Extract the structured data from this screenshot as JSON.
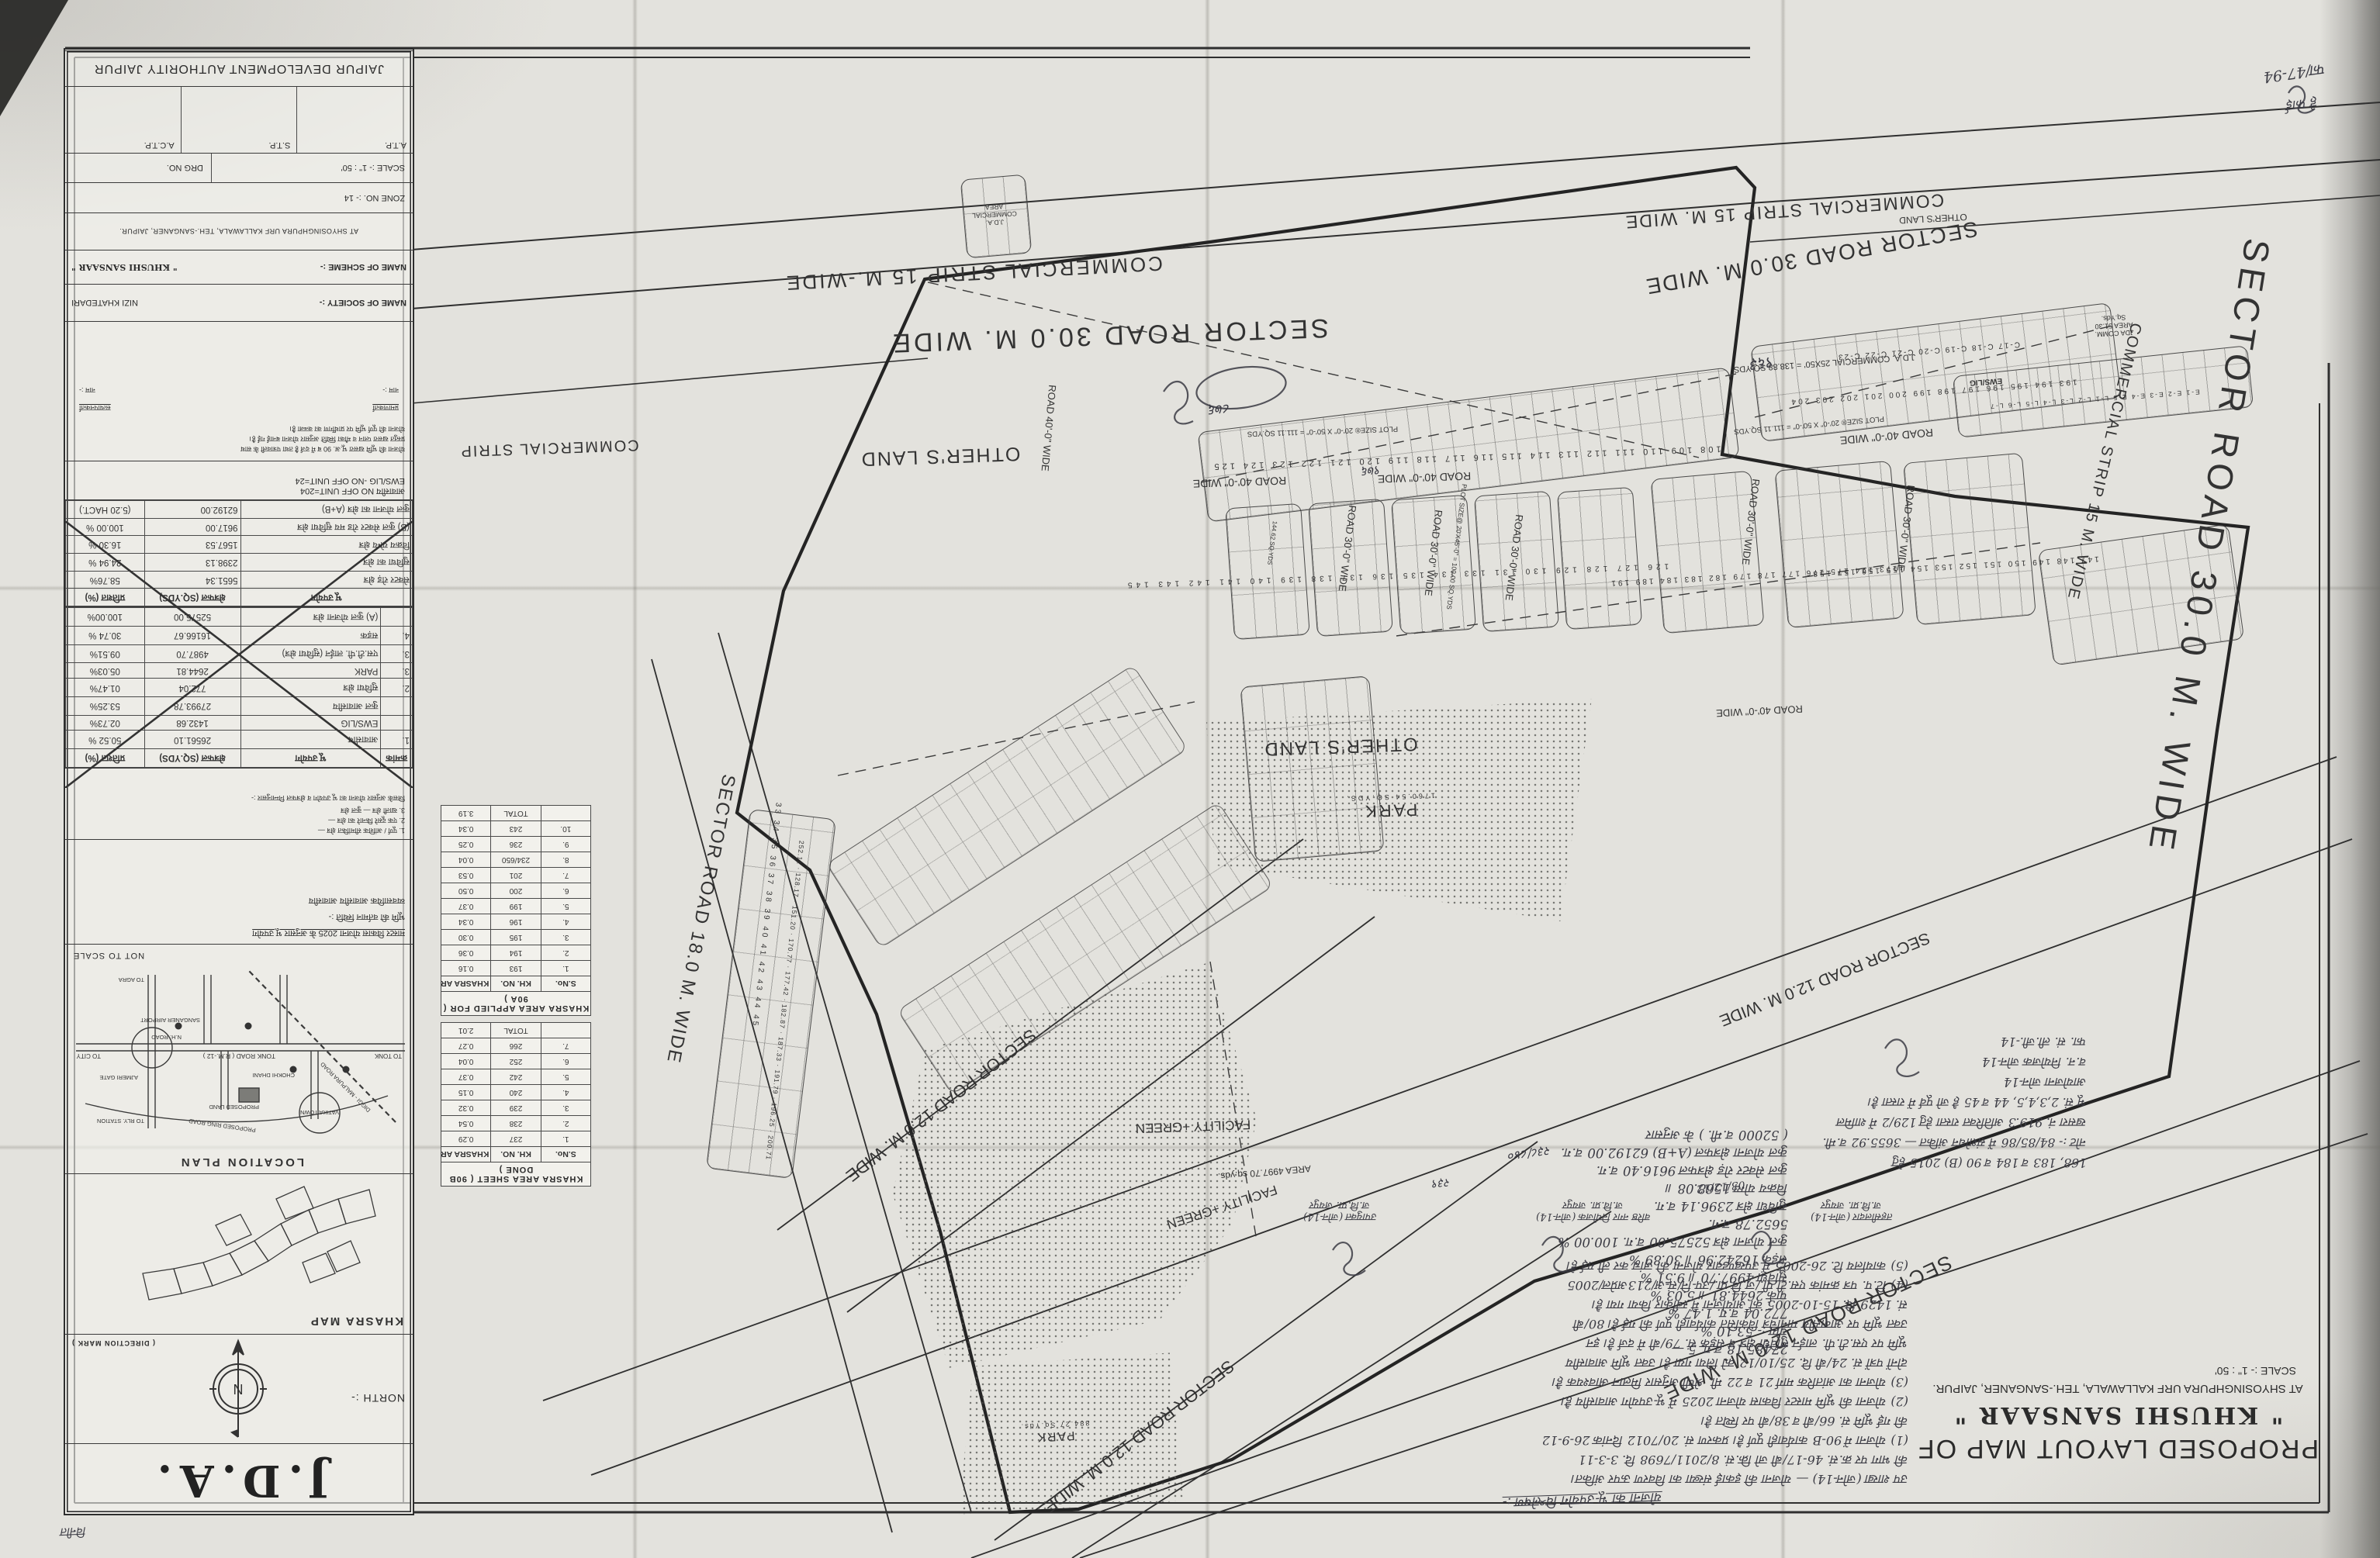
{
  "sheet": {
    "authority": "JAIPUR DEVELOPMENT AUTHORITY JAIPUR",
    "atp": "A.T.P.",
    "stp": "S.T.P.",
    "actp": "A.C.T.P.",
    "scale": "SCALE :- 1\" : 50'",
    "drg": "DRG NO.",
    "zone": "ZONE NO. :- 14",
    "address": "AT SHYOSINGHPURA URF KALLAWALA, TEH.-SANGANER, JAIPUR.",
    "scheme_label": "NAME OF SCHEME :-",
    "scheme_name": "\" KHUSHI SANSAAR \"",
    "society_label": "NAME OF SOCIETY :-",
    "society_name": "NIZI KHATEDARI",
    "title1": "PROPOSED LAYOUT MAP OF",
    "title2": "\" KHUSHI SANSAAR \"",
    "title3": "AT SHYOSINGHPURA URF KALLAWALA, TEH.-SANGANER, JAIPUR.",
    "title4": "SCALE :- 1\" : 50'",
    "jda": "J.D.A.",
    "north": "NORTH :-",
    "direction_mark": "( DIRECTION MARK )",
    "khasra_map": "KHASRA MAP",
    "location_plan": "LOCATION PLAN",
    "nts": "NOT TO SCALE"
  },
  "panel": {
    "units1": "आवासीय   NO OFF UNIT=204",
    "units2": "EWS/LIG -NO OFF UNIT=24",
    "para": [
      "योजना की भूमि खसरा भू.अ. 90 ब में दर्ज है तथा पत्रावली के साथ",
      "प्रस्तुत खसरा प्लान व मौका स्थिति अनुसार योजना बनाई गई है।",
      "योजना की पूर्ण भूमि पर प्रार्थीगण का कब्जा है।"
    ],
    "sig_left": "प्रमाणकर्ता",
    "sig_right": "सत्यापनकर्ता",
    "sig_name": "नाम :-",
    "master": [
      "मास्टर विकास योजना 2025 के अनुसार भू उपयोग",
      "भूमि की वर्तमान स्थिति :-",
      "व्यवसायिक        आवासीय        आवासीय"
    ],
    "notes": [
      "1. पूर्ण / आंशिक सीमांकित क्षेत्र —",
      "2. एक दूसरे किनारे का क्षेत्र —",
      "3. खाली क्षेत्र —  कुल क्षेत्र",
      "जिसके अनुसार योजना का भू उपयोग व क्षेत्रफल निम्नानुसार :-"
    ]
  },
  "tables": {
    "landuse_a": [
      [
        "क्रमांक",
        "भू उपयोग",
        "क्षेत्रफल (SQ.YDS)",
        "प्रतिशत (%)"
      ],
      [
        "1.",
        "आवासीय",
        "26561.10",
        "50.52 %"
      ],
      [
        "",
        "EWS/LIG",
        "1432.68",
        "02.73%"
      ],
      [
        "",
        "कुल आवासीय",
        "27993.78",
        "53.25%"
      ],
      [
        "2.",
        "सुविधा क्षेत्र",
        "772.04",
        "01.47%"
      ],
      [
        "3.",
        "PARK",
        "2644.81",
        "05.03%"
      ],
      [
        "3.",
        "एस.टी.पी. लाईन (सुविधा क्षेत्र)",
        "4987.70",
        "09.51%"
      ],
      [
        "4.",
        "सड़क",
        "16166.67",
        "30.74 %"
      ],
      [
        "",
        "(A) कुल योजना क्षेत्र",
        "52575.00",
        "100.00%"
      ]
    ],
    "landuse_b": [
      [
        "भू उपयोग",
        "क्षेत्रफल (SQ.YDS)",
        "प्रतिशत (%)"
      ],
      [
        "सेक्टर रोड़ क्षेत्र",
        "5651.34",
        "58.76%"
      ],
      [
        "सुविधा का क्षेत्र",
        "2398.13",
        "24.94 %"
      ],
      [
        "विक्रय योग्य क्षेत्र",
        "1567.53",
        "16.30 %"
      ],
      [
        "(B) कुल सेक्टर रोड मय सुविधा क्षेत्र",
        "9617.00",
        "100.00 %"
      ],
      [
        "कुल योजना का क्षेत्र (A+B)",
        "62192.00",
        "(5.20 HACT.)"
      ]
    ],
    "khasra_applied": {
      "title": "KHASRA AREA APPLIED FOR ( 90A )",
      "rows": [
        [
          "S.No.",
          "KH. NO.",
          "KHASRA AREA IN HACT."
        ],
        [
          "1.",
          "193",
          "0.16"
        ],
        [
          "2.",
          "194",
          "0.36"
        ],
        [
          "3.",
          "195",
          "0.30"
        ],
        [
          "4.",
          "196",
          "0.34"
        ],
        [
          "5.",
          "199",
          "0.37"
        ],
        [
          "6.",
          "200",
          "0.50"
        ],
        [
          "7.",
          "201",
          "0.53"
        ],
        [
          "8.",
          "234/650",
          "0.04"
        ],
        [
          "9.",
          "236",
          "0.25"
        ],
        [
          "10.",
          "243",
          "0.34"
        ],
        [
          "",
          "TOTAL",
          "3.19"
        ]
      ]
    },
    "khasra_done": {
      "title": "KHASRA AREA SHEET ( 90B DONE )",
      "rows": [
        [
          "S.No.",
          "KH. NO.",
          "KHASRA AREA IN HACT."
        ],
        [
          "1.",
          "237",
          "0.29"
        ],
        [
          "2.",
          "238",
          "0.54"
        ],
        [
          "3.",
          "239",
          "0.32"
        ],
        [
          "4.",
          "240",
          "0.15"
        ],
        [
          "5.",
          "242",
          "0.37"
        ],
        [
          "6.",
          "252",
          "0.04"
        ],
        [
          "7.",
          "266",
          "0.27"
        ],
        [
          "",
          "TOTAL",
          "2.01"
        ]
      ]
    }
  },
  "map": {
    "sector30": "SECTOR ROAD 30.0 M. WIDE",
    "sector18": "SECTOR ROAD 18.0 M. WIDE",
    "sector12": "SECTOR ROAD 12.0 M. WIDE",
    "comm15": "COMMERCIAL STRIP 15 M. WIDE",
    "comm15b": "COMMERCIAL STRIP 15 M.-WIDE",
    "comm": "COMMERCIAL STRIP",
    "road40": "ROAD 40'-0\" WIDE",
    "road30": "ROAD 30'-0\" WIDE",
    "others": "OTHER'S LAND",
    "park": "PARK",
    "park1_area": "1760.54 SQ.YDS.",
    "park2_area": "884.27 Sq.Yds.",
    "facility": "FACILITY +GREEN",
    "fac_area": "AREA 4997.70 sq.yds.",
    "plot_size_111": "PLOT SIZE® 20'-0\" X 50'-0\" = 111.11 SQ.YDS",
    "plot_size_100": "PLOT SIZE@ 20'X45'-0\" = 100.00 SQ.YDS",
    "jda_comm_row": "J.D.A. COMMERCIAL 25X50' = 138.88 SQ.YDS",
    "jda_comm_area": "JDA COMM. AREA 51.30 Sq.Yds.",
    "jda_comm_area2": "J.D.A. COMMERCIAL AREA",
    "ews": "EWS/LIG",
    "kh963": "९६३",
    "kh876": "८७६",
    "kh976": "९७६",
    "kh238": "२३८/८४०",
    "kh239": "२३९",
    "rows": {
      "top": "108 109 110 111 112 113 114 115 116 117 118 119 120 121 122 123 124 125",
      "r193": "193 194 195 196 197 198 199 200 201 202 203 204",
      "rc": "C-17  C-18  C-19  C-20  C-21  C-22  C-23",
      "rews": "E-1 E-2 E-3 E-4 E-5 L-1 L-2 L-3 L-4 L-5 L-6 L-7",
      "rmid": "126 127 128 129 130 131 133 134 135 136 137 138 139 140 141 142 143 145",
      "rmid2": "147 148 149 150 151 152 153 154 155 156 157 158",
      "rleft": "33 34 35 36 37 38 39 40 41 42 43 44 45",
      "r173": "173 174 175 176 177 178 179 182 183 184 189 191",
      "areas_left": "252.11 · 128.17 · 151.20 · 170.77 · 177.42 · 182.87 · 187.33 · 191.79 · 196.25 · 200.71",
      "area_sample": "144.62 SQ.YDS"
    }
  },
  "location": {
    "tonk_road": "TONK ROAD ( R.M.-12 )",
    "to_city": "TO CITY",
    "to_tonk": "TO TONK",
    "to_agra": "TO AGRA",
    "to_rly": "TO RLY. STATION",
    "airport": "SANGANER AIRPORT",
    "ajmeri": "AJMERI GATE",
    "chokhi": "CHOKHI DHANI",
    "vatika": "VATIKA TOWN",
    "ring": "PROPOSED RING ROAD",
    "diggi": "DIGGI - MALPURA ROAD",
    "proposed": "PROPOSED LAND",
    "nh": "N.H. ROAD"
  },
  "hw": {
    "analysis": "योजना का भू-उपयोग विश्लेषण :-",
    "calc": [
      "( 52000 व.मी. ) के अनुसार",
      "कुल योजना क्षेत्रफल (A+B) 62192.00 व.ग.",
      "कुल सेक्टर रोड़ क्षेत्रफल 9616.40 व.ग.",
      "विक्रय योग्य    1568.08  ॥",
      "सुविधा क्षेत्र   2396.14  व.ग.",
      "5652.78  व.ग.",
      "कुल योजना क्षेत्र  52575.00 व.ग.  100.00 %",
      "सड़क   16242.96  ॥   30.89 %",
      "सुविधा   4997.70  ॥   9.51 %",
      "पार्क   2644.81  ॥   5.03 %",
      "772.04  व.ग.   1.47 %",
      "योग :-  53.10 %",
      "27485.18 व.ग.   5 —"
    ],
    "notes": [
      "(5) कार्यालय टि. 26-2005 में उपखण्डवार योजना की जांच कर ली गई है।",
      "(4) टि.प. पत्र क्रमांक एस.टी.पी./ज.वि.प्रा./उप-नि/सं-अ/213अप्रेल/2005",
      "सं. 1429 दि. 15-10-2005 को आयोजना में स्वीकार किया गया है।",
      "उक्त भूमि पर आवासीय मानचित्र विकसित कार्यवाही पूर्ण की गई है। 80/बी",
      "भूमि पर एस.टी.पी. लाईन सुविधा क्षेत्र व सड़क सं. 79/बी में दर्ज है। इन",
      "दोनों पत्रों सं. 24/बी दि. 25/10/12 को लिया गया है। उक्त भूमि आवासीय",
      "(3) योजना का आंतरिक मार्ग 21 व 22 मी. श्रेणी अनुसार मिलान आवश्यक है।",
      "(2) योजना की भूमि मास्टर विकास योजना 2025 में भू-उपयोग आवासीय है।",
      "की गई भूमि सं. 66/बी व 38/बी पर स्थित है।",
      "(1) योजना में 90-B कार्यवाही पूर्ण है। प्रकरण सं. 20/7012 दिनांक 26-9-12",
      "की भाग पर क्र.सं. 46-17/बी जो क्रि.सं. 8/2011/7698 दि. 3-3-11",
      "उप शाखा (जोन-14) — योजना की इकाई संख्या का विवरण ऊपर अंकित।"
    ],
    "sigs": [
      {
        "a": "उपायुक्त (जोन-14)",
        "b": "ज.वि.प्रा. जयपुर"
      },
      {
        "a": "वरिष्ठ नगर नियोजक (जोन-14)",
        "b": "ज.वि.प्रा. जयपुर"
      },
      {
        "a": "तहसीलदार (जोन-14)",
        "b": "ज.वि.प्रा. जयपुर"
      }
    ],
    "date": "03/12/12",
    "right": [
      "फा. सं. ली.जी.-14",
      "व.न. नियोजक जोन-14",
      "आयोजना जोन-14",
      "भू सं. 2,3,4,5, 44 व 45 है जो पूर्व में रास्ता है।",
      "खसरा नं. 919.3 अतिरिक्त रास्ता हेतु 129/2 में शामिल",
      "नोट :- 84/85/86 में संशोधन अंकित — 3655.92 व.मी.",
      "168, 183 व 184 व 90 (B) 2015 हेतु"
    ],
    "corner": "फा/47-94",
    "corner2": "हे फाई",
    "blm": "विनीत"
  }
}
